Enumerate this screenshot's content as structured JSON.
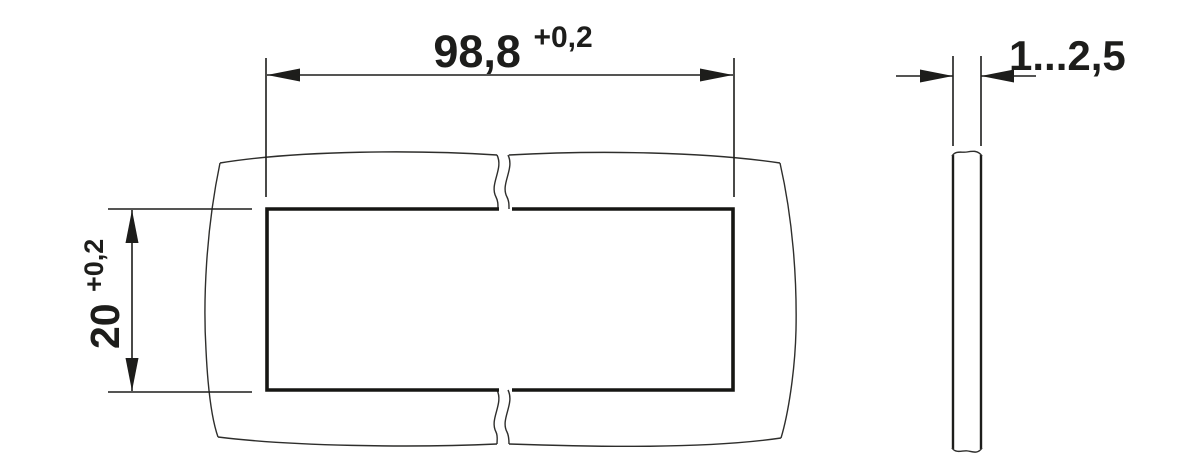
{
  "page": {
    "background": "#ffffff",
    "line_color": "#1d1d1b",
    "description": "panel cutout dimension drawing"
  },
  "front_view": {
    "width_dimension": {
      "value": "98,8",
      "tolerance": "+0,2"
    },
    "height_dimension": {
      "value": "20",
      "tolerance": "+0,2"
    }
  },
  "side_view": {
    "thickness_dimension": {
      "value": "1...2,5"
    }
  }
}
